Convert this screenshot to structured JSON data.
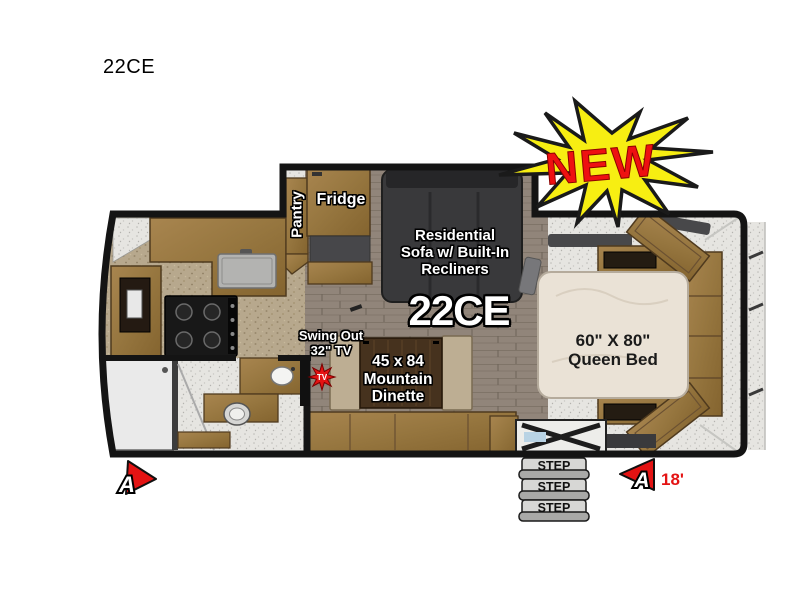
{
  "page": {
    "title": "22CE"
  },
  "badge": {
    "label": "NEW",
    "fill": "#f7ee12",
    "text_color": "#ee1111"
  },
  "floorplan": {
    "model": "22CE",
    "length_label": "18'",
    "marker_letter": "A",
    "labels": {
      "pantry": "Pantry",
      "fridge": "Fridge",
      "sofa_lines": [
        "Residential",
        "Sofa w/ Built-In",
        "Recliners"
      ],
      "tv_lines": [
        "Swing Out",
        "32\" TV"
      ],
      "tv_badge": "TV",
      "dinette_lines": [
        "45 x 84",
        "Mountain",
        "Dinette"
      ],
      "bed_lines": [
        "60\" X 80\"",
        "Queen Bed"
      ],
      "steps": [
        "STEP",
        "STEP",
        "STEP"
      ]
    },
    "colors": {
      "wall_black": "#141414",
      "wood_cabinet": "#9a7a49",
      "wood_floor": "#91857a",
      "cork_floor": "#b7a88d",
      "carpet": "#e6e5e1",
      "sofa_gray": "#39393b",
      "mattress_cream": "#eae2d6",
      "step_gray": "#d7d7d5",
      "accent_red": "#e41313",
      "burst_yellow": "#f7ee12"
    }
  }
}
